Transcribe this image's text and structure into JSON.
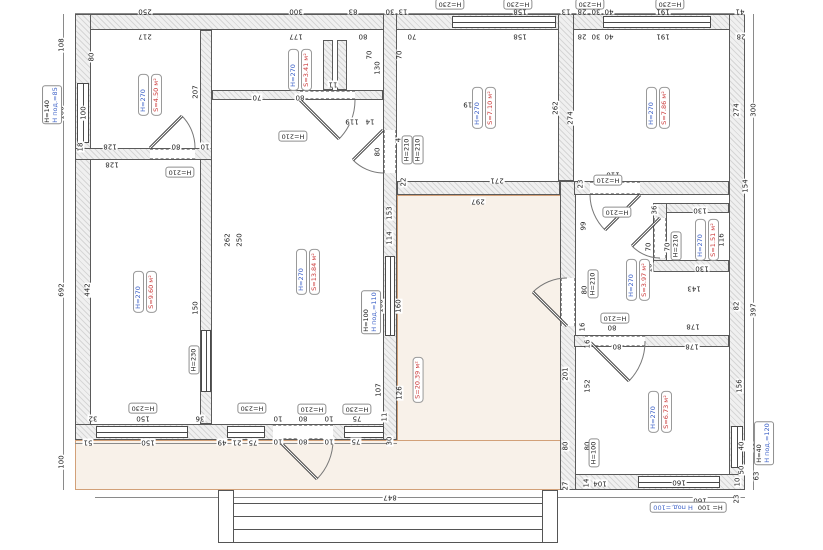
{
  "colors": {
    "accent_blue": "#3f63c8",
    "accent_red": "#cc3b3b",
    "wall_line": "#5a5a5a",
    "terrace_fill": "#f8f1e9",
    "terrace_edge": "#d2a078",
    "dim_text": "#222222"
  },
  "rooms": [
    {
      "h": "H=270",
      "s": "S=4.50 м²",
      "x": 150,
      "y": 95
    },
    {
      "h": "H=270",
      "s": "S=3.41 м²",
      "x": 300,
      "y": 70
    },
    {
      "h": "H=270",
      "s": "S=7.10 м²",
      "x": 484,
      "y": 108
    },
    {
      "h": "H=270",
      "s": "S=7.86 м²",
      "x": 658,
      "y": 108
    },
    {
      "h": "H=270",
      "s": "S=9.60 м²",
      "x": 145,
      "y": 292
    },
    {
      "h": "H=270",
      "s": "S=13.84 м²",
      "x": 308,
      "y": 272
    },
    {
      "h": "H=270",
      "s": "S=3.97 м²",
      "x": 638,
      "y": 280
    },
    {
      "h": "H=270",
      "s": "S=1.51 м²",
      "x": 707,
      "y": 240
    },
    {
      "h": "H=270",
      "s": "S=6.73 м²",
      "x": 660,
      "y": 412
    }
  ],
  "area_label": {
    "text": "S=20.39 м²",
    "x": 418,
    "y": 380
  },
  "boxed_labels": [
    {
      "t": "H=230",
      "x": 450,
      "y": 4
    },
    {
      "t": "H=230",
      "x": 518,
      "y": 4
    },
    {
      "t": "H=230",
      "x": 590,
      "y": 4
    },
    {
      "t": "H=230",
      "x": 670,
      "y": 4
    },
    {
      "t": "H=210",
      "x": 180,
      "y": 172
    },
    {
      "t": "H=210",
      "x": 293,
      "y": 136
    },
    {
      "t": "H=210",
      "x": 407,
      "y": 150,
      "r": "v"
    },
    {
      "t": "H=210",
      "x": 418,
      "y": 150,
      "r": "v"
    },
    {
      "t": "H=210",
      "x": 608,
      "y": 180
    },
    {
      "t": "H=210",
      "x": 617,
      "y": 212
    },
    {
      "t": "H=210",
      "x": 676,
      "y": 246,
      "r": "v"
    },
    {
      "t": "H=210",
      "x": 593,
      "y": 284,
      "r": "v"
    },
    {
      "t": "H=210",
      "x": 615,
      "y": 318
    },
    {
      "t": "H=210",
      "x": 312,
      "y": 409
    },
    {
      "t": "H=230",
      "x": 357,
      "y": 409
    },
    {
      "t": "H=230",
      "x": 143,
      "y": 408
    },
    {
      "t": "H=230",
      "x": 252,
      "y": 408
    },
    {
      "t": "H=230",
      "x": 194,
      "y": 360,
      "r": "v"
    },
    {
      "t": "H=100",
      "x": 594,
      "y": 453,
      "r": "v"
    }
  ],
  "window_labels": [
    {
      "lines": [
        {
          "t": "H=140",
          "c": "k"
        },
        {
          "t": "H под.=85",
          "c": "b"
        }
      ],
      "x": 52,
      "y": 105,
      "r": "v"
    },
    {
      "lines": [
        {
          "t": "H=100",
          "c": "k"
        },
        {
          "t": "H под.=110",
          "c": "b"
        }
      ],
      "x": 371,
      "y": 312,
      "r": "v"
    },
    {
      "lines": [
        {
          "t": "H=40",
          "c": "k"
        },
        {
          "t": "H под.=120",
          "c": "b"
        }
      ],
      "x": 764,
      "y": 443,
      "r": "v"
    },
    {
      "lines": [
        {
          "t": "H= 100",
          "c": "k"
        },
        {
          "t": "H под.=100",
          "c": "b"
        }
      ],
      "x": 688,
      "y": 507,
      "r": "h"
    }
  ],
  "dims": [
    {
      "t": "250",
      "x": 145,
      "y": 11
    },
    {
      "t": "300",
      "x": 296,
      "y": 11
    },
    {
      "t": "83",
      "x": 353,
      "y": 11
    },
    {
      "t": "30",
      "x": 390,
      "y": 11
    },
    {
      "t": "13",
      "x": 403,
      "y": 11
    },
    {
      "t": "158",
      "x": 520,
      "y": 11
    },
    {
      "t": "13",
      "x": 566,
      "y": 11
    },
    {
      "t": "28",
      "x": 582,
      "y": 11
    },
    {
      "t": "30",
      "x": 596,
      "y": 11
    },
    {
      "t": "40",
      "x": 609,
      "y": 11
    },
    {
      "t": "191",
      "x": 663,
      "y": 11
    },
    {
      "t": "41",
      "x": 740,
      "y": 11
    },
    {
      "t": "217",
      "x": 145,
      "y": 36
    },
    {
      "t": "177",
      "x": 296,
      "y": 36
    },
    {
      "t": "80",
      "x": 363,
      "y": 36
    },
    {
      "t": "70",
      "x": 412,
      "y": 36
    },
    {
      "t": "158",
      "x": 520,
      "y": 36
    },
    {
      "t": "28",
      "x": 582,
      "y": 36
    },
    {
      "t": "30",
      "x": 596,
      "y": 36
    },
    {
      "t": "40",
      "x": 609,
      "y": 36
    },
    {
      "t": "191",
      "x": 663,
      "y": 36
    },
    {
      "t": "28",
      "x": 741,
      "y": 36
    },
    {
      "t": "108",
      "x": 62,
      "y": 45,
      "r": "v"
    },
    {
      "t": "100",
      "x": 62,
      "y": 113,
      "r": "v"
    },
    {
      "t": "100",
      "x": 84,
      "y": 113,
      "r": "v"
    },
    {
      "t": "18",
      "x": 81,
      "y": 147,
      "r": "v"
    },
    {
      "t": "692",
      "x": 62,
      "y": 290,
      "r": "v"
    },
    {
      "t": "442",
      "x": 88,
      "y": 290,
      "r": "v"
    },
    {
      "t": "100",
      "x": 62,
      "y": 462,
      "r": "v"
    },
    {
      "t": "80",
      "x": 92,
      "y": 57,
      "r": "v"
    },
    {
      "t": "207",
      "x": 196,
      "y": 92,
      "r": "v"
    },
    {
      "t": "128",
      "x": 110,
      "y": 146
    },
    {
      "t": "128",
      "x": 112,
      "y": 164
    },
    {
      "t": "80",
      "x": 176,
      "y": 146
    },
    {
      "t": "10",
      "x": 205,
      "y": 146
    },
    {
      "t": "262",
      "x": 228,
      "y": 240,
      "r": "v"
    },
    {
      "t": "250",
      "x": 240,
      "y": 240,
      "r": "v"
    },
    {
      "t": "150",
      "x": 196,
      "y": 308,
      "r": "v"
    },
    {
      "t": "70",
      "x": 257,
      "y": 97
    },
    {
      "t": "80",
      "x": 300,
      "y": 97
    },
    {
      "t": "119",
      "x": 470,
      "y": 104
    },
    {
      "t": "119",
      "x": 352,
      "y": 121
    },
    {
      "t": "14",
      "x": 370,
      "y": 121
    },
    {
      "t": "130",
      "x": 378,
      "y": 68,
      "r": "v"
    },
    {
      "t": "70",
      "x": 370,
      "y": 55,
      "r": "v"
    },
    {
      "t": "70",
      "x": 400,
      "y": 55,
      "r": "v"
    },
    {
      "t": "11",
      "x": 333,
      "y": 84
    },
    {
      "t": "80",
      "x": 378,
      "y": 152,
      "r": "v"
    },
    {
      "t": "4",
      "x": 399,
      "y": 140,
      "r": "v"
    },
    {
      "t": "22",
      "x": 404,
      "y": 182,
      "r": "v"
    },
    {
      "t": "153",
      "x": 390,
      "y": 213,
      "r": "v"
    },
    {
      "t": "114",
      "x": 390,
      "y": 238,
      "r": "v"
    },
    {
      "t": "160",
      "x": 381,
      "y": 306,
      "r": "v"
    },
    {
      "t": "160",
      "x": 399,
      "y": 306,
      "r": "v"
    },
    {
      "t": "107",
      "x": 379,
      "y": 390,
      "r": "v"
    },
    {
      "t": "126",
      "x": 400,
      "y": 393,
      "r": "v"
    },
    {
      "t": "297",
      "x": 478,
      "y": 201
    },
    {
      "t": "262",
      "x": 556,
      "y": 108,
      "r": "v"
    },
    {
      "t": "274",
      "x": 571,
      "y": 118,
      "r": "v"
    },
    {
      "t": "271",
      "x": 497,
      "y": 180
    },
    {
      "t": "23",
      "x": 581,
      "y": 184,
      "r": "v"
    },
    {
      "t": "274",
      "x": 737,
      "y": 110,
      "r": "v"
    },
    {
      "t": "300",
      "x": 754,
      "y": 110,
      "r": "v"
    },
    {
      "t": "154",
      "x": 746,
      "y": 186,
      "r": "v"
    },
    {
      "t": "110",
      "x": 613,
      "y": 174
    },
    {
      "t": "110",
      "x": 613,
      "y": 210
    },
    {
      "t": "36",
      "x": 655,
      "y": 210,
      "r": "v"
    },
    {
      "t": "130",
      "x": 700,
      "y": 210
    },
    {
      "t": "116",
      "x": 722,
      "y": 240,
      "r": "v"
    },
    {
      "t": "130",
      "x": 702,
      "y": 268
    },
    {
      "t": "70",
      "x": 649,
      "y": 247,
      "r": "v"
    },
    {
      "t": "70",
      "x": 668,
      "y": 247,
      "r": "v"
    },
    {
      "t": "10",
      "x": 650,
      "y": 268,
      "r": "v"
    },
    {
      "t": "99",
      "x": 584,
      "y": 226,
      "r": "v"
    },
    {
      "t": "80",
      "x": 585,
      "y": 290,
      "r": "v"
    },
    {
      "t": "16",
      "x": 583,
      "y": 327,
      "r": "v"
    },
    {
      "t": "80",
      "x": 612,
      "y": 327
    },
    {
      "t": "143",
      "x": 694,
      "y": 288
    },
    {
      "t": "82",
      "x": 737,
      "y": 306,
      "r": "v"
    },
    {
      "t": "178",
      "x": 693,
      "y": 326
    },
    {
      "t": "397",
      "x": 754,
      "y": 310,
      "r": "v"
    },
    {
      "t": "201",
      "x": 566,
      "y": 374,
      "r": "v"
    },
    {
      "t": "152",
      "x": 588,
      "y": 386,
      "r": "v"
    },
    {
      "t": "16",
      "x": 588,
      "y": 344,
      "r": "v"
    },
    {
      "t": "80",
      "x": 617,
      "y": 346
    },
    {
      "t": "178",
      "x": 692,
      "y": 346
    },
    {
      "t": "156",
      "x": 740,
      "y": 386,
      "r": "v"
    },
    {
      "t": "80",
      "x": 566,
      "y": 446,
      "r": "v"
    },
    {
      "t": "80",
      "x": 588,
      "y": 446,
      "r": "v"
    },
    {
      "t": "40",
      "x": 742,
      "y": 446,
      "r": "v"
    },
    {
      "t": "40",
      "x": 757,
      "y": 447,
      "r": "v"
    },
    {
      "t": "50",
      "x": 742,
      "y": 470,
      "r": "v"
    },
    {
      "t": "63",
      "x": 757,
      "y": 476,
      "r": "v"
    },
    {
      "t": "27",
      "x": 566,
      "y": 486,
      "r": "v"
    },
    {
      "t": "14",
      "x": 587,
      "y": 483,
      "r": "v"
    },
    {
      "t": "104",
      "x": 600,
      "y": 483
    },
    {
      "t": "160",
      "x": 679,
      "y": 482
    },
    {
      "t": "10",
      "x": 738,
      "y": 482,
      "r": "v"
    },
    {
      "t": "160",
      "x": 700,
      "y": 500
    },
    {
      "t": "23",
      "x": 737,
      "y": 499,
      "r": "v"
    },
    {
      "t": "32",
      "x": 93,
      "y": 418
    },
    {
      "t": "150",
      "x": 143,
      "y": 418
    },
    {
      "t": "36",
      "x": 200,
      "y": 418
    },
    {
      "t": "10",
      "x": 278,
      "y": 418
    },
    {
      "t": "80",
      "x": 303,
      "y": 418
    },
    {
      "t": "10",
      "x": 329,
      "y": 418
    },
    {
      "t": "75",
      "x": 357,
      "y": 418
    },
    {
      "t": "11",
      "x": 385,
      "y": 417,
      "r": "v"
    },
    {
      "t": "51",
      "x": 88,
      "y": 442
    },
    {
      "t": "150",
      "x": 148,
      "y": 442
    },
    {
      "t": "49",
      "x": 222,
      "y": 442
    },
    {
      "t": "21",
      "x": 237,
      "y": 442
    },
    {
      "t": "75",
      "x": 253,
      "y": 442
    },
    {
      "t": "10",
      "x": 278,
      "y": 441
    },
    {
      "t": "80",
      "x": 303,
      "y": 441
    },
    {
      "t": "10",
      "x": 329,
      "y": 441
    },
    {
      "t": "75",
      "x": 356,
      "y": 441
    },
    {
      "t": "30",
      "x": 390,
      "y": 441,
      "r": "v"
    },
    {
      "t": "847",
      "x": 390,
      "y": 497
    }
  ]
}
